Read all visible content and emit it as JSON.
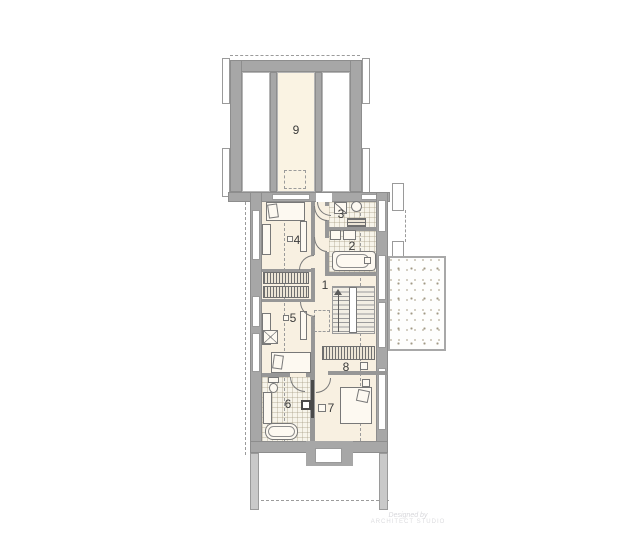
{
  "plan_type": "second-floor-architectural-plan",
  "rooms": {
    "r1": "1",
    "r2": "2",
    "r3": "3",
    "r4": "4",
    "r5": "5",
    "r6": "6",
    "r7": "7",
    "r8": "8",
    "r9": "9"
  },
  "watermark": {
    "line1": "Designed by",
    "line2": "ARCHITECT STUDIO"
  },
  "colors": {
    "background": "#ffffff",
    "exterior_wall": "#a7a7a7",
    "wall_edge": "#8d8d8d",
    "floor_cream": "#f8f0e1",
    "tile_floor": "#f7f4ea",
    "dash_line": "#9b9b9b",
    "label_text": "#3b3b3b",
    "watermark_text": "#d7d7db"
  },
  "icons": {
    "bed": "rect-with-pillow",
    "bathtub": "rounded-rect",
    "sink": "small-rect",
    "washing-machine": "square-with-diagonal",
    "boiler": "circle",
    "toilet": "tank-and-bowl",
    "wardrobe": "vertical-hatch-band",
    "radiator": "horizontal-hatch-band",
    "stairs-up-arrow": "vertical-arrow",
    "shower-cabinet": "square-with-x",
    "chimney": "gray-block-white-core"
  }
}
